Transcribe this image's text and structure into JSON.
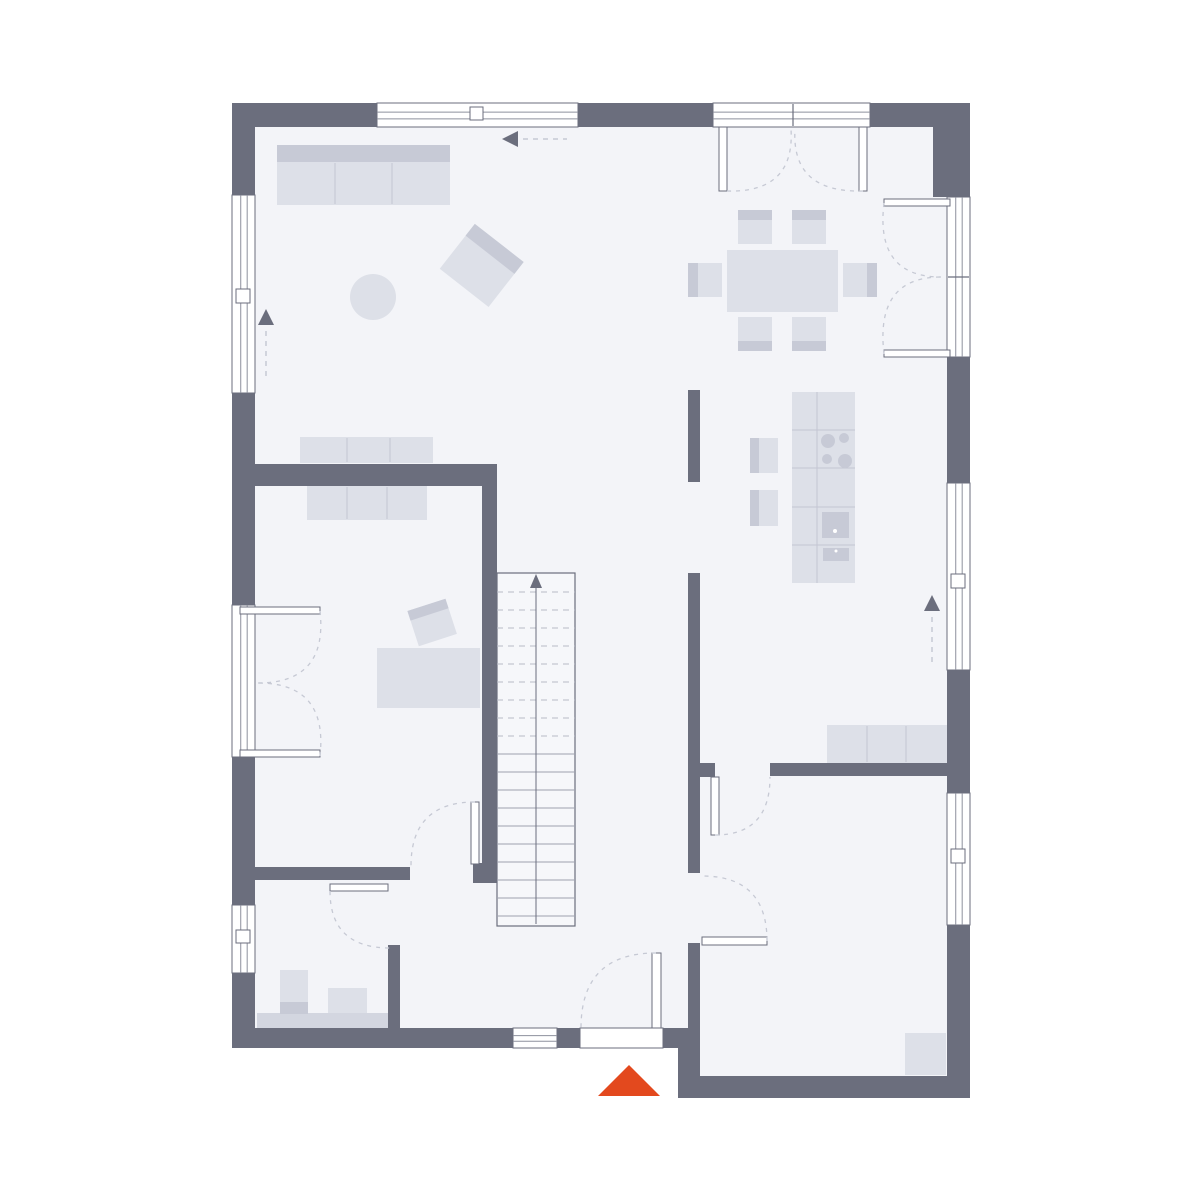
{
  "page": {
    "background": "#ffffff"
  },
  "plan": {
    "canvas": {
      "w": 1200,
      "h": 1200
    },
    "colors": {
      "wall": "#6b6e7d",
      "floor": "#f3f4f8",
      "stair_fill": "#f6f7fa",
      "white": "#ffffff",
      "furniture": "#dde0e8",
      "furniture_dark": "#c7cad6",
      "furniture_mid": "#d3d6e0",
      "furniture_line": "#c3c6d2",
      "frame": "#6b6e7d",
      "thin_line": "#8d909d",
      "dash": "#c6c9d4",
      "tread": "#9da1af",
      "tread_dash": "#b8bbc7",
      "arrow": "#6b6e7d",
      "accent": "#e3491e"
    },
    "floor_regions": [
      {
        "name": "floor-main",
        "x": 243,
        "y": 114,
        "w": 716,
        "h": 925
      },
      {
        "name": "floor-utility-room",
        "x": 688,
        "y": 1020,
        "w": 271,
        "h": 68
      }
    ],
    "furniture": [
      {
        "name": "sofa",
        "parts": [
          {
            "t": "rect",
            "x": 277,
            "y": 145,
            "w": 173,
            "h": 60,
            "f": "@furniture_dark"
          },
          {
            "t": "rect",
            "x": 277,
            "y": 162,
            "w": 173,
            "h": 43,
            "f": "@furniture"
          },
          {
            "t": "line",
            "x1": 335,
            "y1": 163,
            "x2": 335,
            "y2": 204,
            "s": "@furniture_line"
          },
          {
            "t": "line",
            "x1": 392,
            "y1": 163,
            "x2": 392,
            "y2": 204,
            "s": "@furniture_line"
          }
        ]
      },
      {
        "name": "coffee-table",
        "parts": [
          {
            "t": "circle",
            "cx": 373,
            "cy": 297,
            "r": 23,
            "f": "@furniture"
          }
        ]
      },
      {
        "name": "armchair",
        "rot": "rotate(38 482 265)",
        "parts": [
          {
            "t": "rect",
            "x": 451,
            "y": 237,
            "w": 62,
            "h": 57,
            "f": "@furniture"
          },
          {
            "t": "rect",
            "x": 451,
            "y": 237,
            "w": 62,
            "h": 15,
            "f": "@furniture_dark"
          }
        ]
      },
      {
        "name": "dining-table",
        "parts": [
          {
            "t": "rect",
            "x": 727,
            "y": 250,
            "w": 111,
            "h": 62,
            "f": "@furniture"
          }
        ]
      },
      {
        "name": "dining-chair-top-left",
        "parts": [
          {
            "t": "rect",
            "x": 738,
            "y": 210,
            "w": 34,
            "h": 34,
            "f": "@furniture"
          },
          {
            "t": "rect",
            "x": 738,
            "y": 210,
            "w": 34,
            "h": 10,
            "f": "@furniture_dark"
          }
        ]
      },
      {
        "name": "dining-chair-top-right",
        "parts": [
          {
            "t": "rect",
            "x": 792,
            "y": 210,
            "w": 34,
            "h": 34,
            "f": "@furniture"
          },
          {
            "t": "rect",
            "x": 792,
            "y": 210,
            "w": 34,
            "h": 10,
            "f": "@furniture_dark"
          }
        ]
      },
      {
        "name": "dining-chair-bottom-left",
        "parts": [
          {
            "t": "rect",
            "x": 738,
            "y": 317,
            "w": 34,
            "h": 34,
            "f": "@furniture"
          },
          {
            "t": "rect",
            "x": 738,
            "y": 341,
            "w": 34,
            "h": 10,
            "f": "@furniture_dark"
          }
        ]
      },
      {
        "name": "dining-chair-bottom-right",
        "parts": [
          {
            "t": "rect",
            "x": 792,
            "y": 317,
            "w": 34,
            "h": 34,
            "f": "@furniture"
          },
          {
            "t": "rect",
            "x": 792,
            "y": 341,
            "w": 34,
            "h": 10,
            "f": "@furniture_dark"
          }
        ]
      },
      {
        "name": "dining-chair-left",
        "parts": [
          {
            "t": "rect",
            "x": 688,
            "y": 263,
            "w": 34,
            "h": 34,
            "f": "@furniture"
          },
          {
            "t": "rect",
            "x": 688,
            "y": 263,
            "w": 10,
            "h": 34,
            "f": "@furniture_dark"
          }
        ]
      },
      {
        "name": "dining-chair-right",
        "parts": [
          {
            "t": "rect",
            "x": 843,
            "y": 263,
            "w": 34,
            "h": 34,
            "f": "@furniture"
          },
          {
            "t": "rect",
            "x": 867,
            "y": 263,
            "w": 10,
            "h": 34,
            "f": "@furniture_dark"
          }
        ]
      },
      {
        "name": "kitchen-island",
        "parts": [
          {
            "t": "rect",
            "x": 792,
            "y": 392,
            "w": 63,
            "h": 191,
            "f": "@furniture"
          },
          {
            "t": "line",
            "x1": 817,
            "y1": 392,
            "x2": 817,
            "y2": 583,
            "s": "@furniture_line"
          },
          {
            "t": "line",
            "x1": 792,
            "y1": 430,
            "x2": 855,
            "y2": 430,
            "s": "@furniture_line"
          },
          {
            "t": "line",
            "x1": 792,
            "y1": 468,
            "x2": 855,
            "y2": 468,
            "s": "@furniture_line"
          },
          {
            "t": "line",
            "x1": 792,
            "y1": 507,
            "x2": 855,
            "y2": 507,
            "s": "@furniture_line"
          },
          {
            "t": "line",
            "x1": 792,
            "y1": 545,
            "x2": 855,
            "y2": 545,
            "s": "@furniture_line"
          },
          {
            "t": "circle",
            "cx": 828,
            "cy": 441,
            "r": 7,
            "f": "@furniture_dark"
          },
          {
            "t": "circle",
            "cx": 844,
            "cy": 438,
            "r": 5,
            "f": "@furniture_dark"
          },
          {
            "t": "circle",
            "cx": 827,
            "cy": 459,
            "r": 5,
            "f": "@furniture_dark"
          },
          {
            "t": "circle",
            "cx": 845,
            "cy": 461,
            "r": 7,
            "f": "@furniture_dark"
          },
          {
            "t": "rect",
            "x": 822,
            "y": 512,
            "w": 27,
            "h": 26,
            "f": "@furniture_dark"
          },
          {
            "t": "circle",
            "cx": 835,
            "cy": 531,
            "r": 2,
            "f": "@white"
          },
          {
            "t": "rect",
            "x": 823,
            "y": 548,
            "w": 26,
            "h": 13,
            "f": "@furniture_dark"
          },
          {
            "t": "circle",
            "cx": 836,
            "cy": 551,
            "r": 1.5,
            "f": "@white"
          }
        ]
      },
      {
        "name": "kitchen-stool-1",
        "parts": [
          {
            "t": "rect",
            "x": 750,
            "y": 438,
            "w": 28,
            "h": 35,
            "f": "@furniture"
          },
          {
            "t": "rect",
            "x": 750,
            "y": 438,
            "w": 9,
            "h": 35,
            "f": "@furniture_dark"
          }
        ]
      },
      {
        "name": "kitchen-stool-2",
        "parts": [
          {
            "t": "rect",
            "x": 750,
            "y": 490,
            "w": 28,
            "h": 36,
            "f": "@furniture"
          },
          {
            "t": "rect",
            "x": 750,
            "y": 490,
            "w": 9,
            "h": 36,
            "f": "@furniture_dark"
          }
        ]
      },
      {
        "name": "sideboard-living",
        "parts": [
          {
            "t": "rect",
            "x": 300,
            "y": 437,
            "w": 133,
            "h": 26,
            "f": "@furniture"
          },
          {
            "t": "line",
            "x1": 347,
            "y1": 438,
            "x2": 347,
            "y2": 462,
            "s": "@furniture_line"
          },
          {
            "t": "line",
            "x1": 390,
            "y1": 438,
            "x2": 390,
            "y2": 462,
            "s": "@furniture_line"
          }
        ]
      },
      {
        "name": "office-wardrobe",
        "parts": [
          {
            "t": "rect",
            "x": 307,
            "y": 486,
            "w": 120,
            "h": 34,
            "f": "@furniture"
          },
          {
            "t": "line",
            "x1": 347,
            "y1": 487,
            "x2": 347,
            "y2": 519,
            "s": "@furniture_line"
          },
          {
            "t": "line",
            "x1": 387,
            "y1": 487,
            "x2": 387,
            "y2": 519,
            "s": "@furniture_line"
          }
        ]
      },
      {
        "name": "office-desk",
        "parts": [
          {
            "t": "rect",
            "x": 377,
            "y": 648,
            "w": 103,
            "h": 60,
            "f": "@furniture"
          }
        ]
      },
      {
        "name": "office-chair",
        "rot": "rotate(-18 432 622)",
        "parts": [
          {
            "t": "rect",
            "x": 412,
            "y": 604,
            "w": 40,
            "h": 37,
            "f": "@furniture"
          },
          {
            "t": "rect",
            "x": 412,
            "y": 604,
            "w": 40,
            "h": 10,
            "f": "@furniture_dark"
          }
        ]
      },
      {
        "name": "sideboard-utility",
        "parts": [
          {
            "t": "rect",
            "x": 827,
            "y": 725,
            "w": 120,
            "h": 38,
            "f": "@furniture"
          },
          {
            "t": "line",
            "x1": 867,
            "y1": 726,
            "x2": 867,
            "y2": 762,
            "s": "@furniture_line"
          },
          {
            "t": "line",
            "x1": 906,
            "y1": 726,
            "x2": 906,
            "y2": 762,
            "s": "@furniture_line"
          }
        ]
      },
      {
        "name": "wc-countertop",
        "parts": [
          {
            "t": "rect",
            "x": 257,
            "y": 1013,
            "w": 131,
            "h": 15,
            "f": "@furniture_mid"
          }
        ]
      },
      {
        "name": "wc-toilet",
        "parts": [
          {
            "t": "rect",
            "x": 280,
            "y": 970,
            "w": 28,
            "h": 33,
            "f": "@furniture"
          },
          {
            "t": "rect",
            "x": 280,
            "y": 1002,
            "w": 28,
            "h": 12,
            "f": "@furniture_dark"
          }
        ]
      },
      {
        "name": "wc-sink",
        "parts": [
          {
            "t": "rect",
            "x": 328,
            "y": 988,
            "w": 39,
            "h": 25,
            "f": "@furniture"
          }
        ]
      },
      {
        "name": "utility-corner-unit",
        "parts": [
          {
            "t": "rect",
            "x": 905,
            "y": 1033,
            "w": 41,
            "h": 42,
            "f": "@furniture"
          }
        ]
      }
    ],
    "stairs": {
      "name": "staircase",
      "x": 497,
      "y": 573,
      "w": 78,
      "h": 353,
      "treadStart": 592,
      "treadStep": 18,
      "treadCount": 19,
      "dashedCount": 9,
      "centerX": 536,
      "lineTop": 588,
      "lineBottom": 924,
      "arrowHead": "536,574 530,588 542,588"
    },
    "walls": [
      {
        "name": "wall-top",
        "x": 232,
        "y": 103,
        "w": 738,
        "h": 24
      },
      {
        "name": "wall-left",
        "x": 232,
        "y": 103,
        "w": 23,
        "h": 945
      },
      {
        "name": "wall-right",
        "x": 947,
        "y": 103,
        "w": 23,
        "h": 995
      },
      {
        "name": "wall-corner-pier-top-right",
        "x": 933,
        "y": 103,
        "w": 37,
        "h": 94
      },
      {
        "name": "wall-bottom-main",
        "x": 232,
        "y": 1028,
        "w": 468,
        "h": 20
      },
      {
        "name": "wall-bottom-utility-room",
        "x": 678,
        "y": 1076,
        "w": 292,
        "h": 22
      },
      {
        "name": "wall-utility-room-left",
        "x": 688,
        "y": 943,
        "w": 12,
        "h": 105
      },
      {
        "name": "wall-utility-room-left-lower",
        "x": 678,
        "y": 1048,
        "w": 22,
        "h": 28
      },
      {
        "name": "wall-office-top",
        "x": 255,
        "y": 464,
        "w": 242,
        "h": 22
      },
      {
        "name": "wall-stairs",
        "x": 482,
        "y": 486,
        "w": 15,
        "h": 377
      },
      {
        "name": "wall-stairs-foot",
        "x": 473,
        "y": 863,
        "w": 24,
        "h": 20
      },
      {
        "name": "wall-kitchen-partition-upper",
        "x": 688,
        "y": 390,
        "w": 12,
        "h": 92
      },
      {
        "name": "wall-hall-partition",
        "x": 688,
        "y": 573,
        "w": 12,
        "h": 300
      },
      {
        "name": "wall-hall-partition-jamb",
        "x": 700,
        "y": 763,
        "w": 15,
        "h": 14
      },
      {
        "name": "wall-room-divider-horizontal",
        "x": 770,
        "y": 763,
        "w": 177,
        "h": 13
      },
      {
        "name": "wall-wc-top",
        "x": 255,
        "y": 867,
        "w": 155,
        "h": 13
      },
      {
        "name": "wall-wc-right",
        "x": 388,
        "y": 945,
        "w": 12,
        "h": 83
      }
    ],
    "windows": [
      {
        "name": "window-top",
        "x": 377,
        "y": 103,
        "w": 201,
        "h": 24,
        "o": "h",
        "marker": [
          470,
          107,
          13,
          13
        ]
      },
      {
        "name": "terrace-door-top",
        "x": 713,
        "y": 103,
        "w": 157,
        "h": 24,
        "o": "h",
        "mull": [
          793,
          104,
          793,
          126
        ]
      },
      {
        "name": "patio-door-right",
        "x": 947,
        "y": 197,
        "w": 23,
        "h": 160,
        "o": "v",
        "mull": [
          948,
          277,
          969,
          277
        ]
      },
      {
        "name": "window-right-kitchen",
        "x": 947,
        "y": 483,
        "w": 23,
        "h": 187,
        "o": "v",
        "marker": [
          951,
          574,
          14,
          14
        ]
      },
      {
        "name": "window-right-utility",
        "x": 947,
        "y": 793,
        "w": 23,
        "h": 132,
        "o": "v",
        "marker": [
          951,
          849,
          14,
          14
        ]
      },
      {
        "name": "window-left-living",
        "x": 232,
        "y": 195,
        "w": 23,
        "h": 198,
        "o": "v",
        "marker": [
          236,
          289,
          14,
          14
        ]
      },
      {
        "name": "french-door-left",
        "x": 232,
        "y": 605,
        "w": 23,
        "h": 152,
        "o": "v"
      },
      {
        "name": "window-left-wc",
        "x": 232,
        "y": 905,
        "w": 23,
        "h": 68,
        "o": "v",
        "marker": [
          236,
          930,
          14,
          13
        ]
      },
      {
        "name": "window-bottom-small",
        "x": 513,
        "y": 1028,
        "w": 44,
        "h": 20,
        "o": "h"
      },
      {
        "name": "entry-door-opening",
        "x": 580,
        "y": 1028,
        "w": 83,
        "h": 20,
        "o": "h",
        "plain": true
      }
    ],
    "door_leaves": [
      {
        "name": "terrace-door-left-leaf",
        "x": 719,
        "y": 127,
        "w": 8,
        "h": 64
      },
      {
        "name": "terrace-door-right-leaf",
        "x": 859,
        "y": 127,
        "w": 8,
        "h": 64
      },
      {
        "name": "patio-door-top-leaf",
        "x": 884,
        "y": 199,
        "w": 66,
        "h": 7
      },
      {
        "name": "patio-door-bottom-leaf",
        "x": 884,
        "y": 350,
        "w": 66,
        "h": 7
      },
      {
        "name": "french-door-top-leaf",
        "x": 240,
        "y": 607,
        "w": 80,
        "h": 7
      },
      {
        "name": "french-door-bottom-leaf",
        "x": 240,
        "y": 750,
        "w": 80,
        "h": 7
      },
      {
        "name": "hall-door-leaf",
        "x": 471,
        "y": 802,
        "w": 8,
        "h": 62
      },
      {
        "name": "wc-door-leaf",
        "x": 330,
        "y": 884,
        "w": 58,
        "h": 7
      },
      {
        "name": "kitchen-room-door-leaf",
        "x": 711,
        "y": 777,
        "w": 8,
        "h": 58
      },
      {
        "name": "utility-room-door-leaf",
        "x": 702,
        "y": 937,
        "w": 65,
        "h": 8
      },
      {
        "name": "entry-door-leaf",
        "x": 652,
        "y": 953,
        "w": 9,
        "h": 75
      }
    ],
    "door_swings": [
      {
        "name": "terrace-door-left-swing",
        "d": "M727,191 Q795,193 791,129"
      },
      {
        "name": "terrace-door-right-swing",
        "d": "M863,191 Q791,193 795,129"
      },
      {
        "name": "patio-door-top-swing",
        "d": "M884,203 Q875,277 941,277"
      },
      {
        "name": "patio-door-bottom-swing",
        "d": "M884,354 Q875,277 941,277"
      },
      {
        "name": "french-door-top-swing",
        "d": "M320,611 Q328,683 258,683"
      },
      {
        "name": "french-door-bottom-swing",
        "d": "M320,756 Q328,683 258,683"
      },
      {
        "name": "hall-door-swing",
        "d": "M475,802 Q411,802 411,866"
      },
      {
        "name": "wc-door-swing",
        "d": "M330,891 Q330,948 390,948"
      },
      {
        "name": "kitchen-room-door-swing",
        "d": "M715,835 Q770,835 770,777"
      },
      {
        "name": "utility-room-door-swing",
        "d": "M767,941 Q767,876 702,876"
      },
      {
        "name": "entry-door-swing",
        "d": "M656,953 Q581,953 581,1028"
      }
    ],
    "arrows": [
      {
        "name": "circulation-arrow-top",
        "head": "502,139 518,131 518,147",
        "tail": [
          523,
          139,
          567,
          139
        ]
      },
      {
        "name": "circulation-arrow-left",
        "head": "266,309 258,325 274,325",
        "tail": [
          266,
          331,
          266,
          378
        ]
      },
      {
        "name": "circulation-arrow-right",
        "head": "932,595 924,611 940,611",
        "tail": [
          932,
          617,
          932,
          663
        ]
      },
      {
        "name": "entrance-arrow",
        "head": "629,1065 598,1096 660,1096",
        "accent": true
      }
    ]
  }
}
